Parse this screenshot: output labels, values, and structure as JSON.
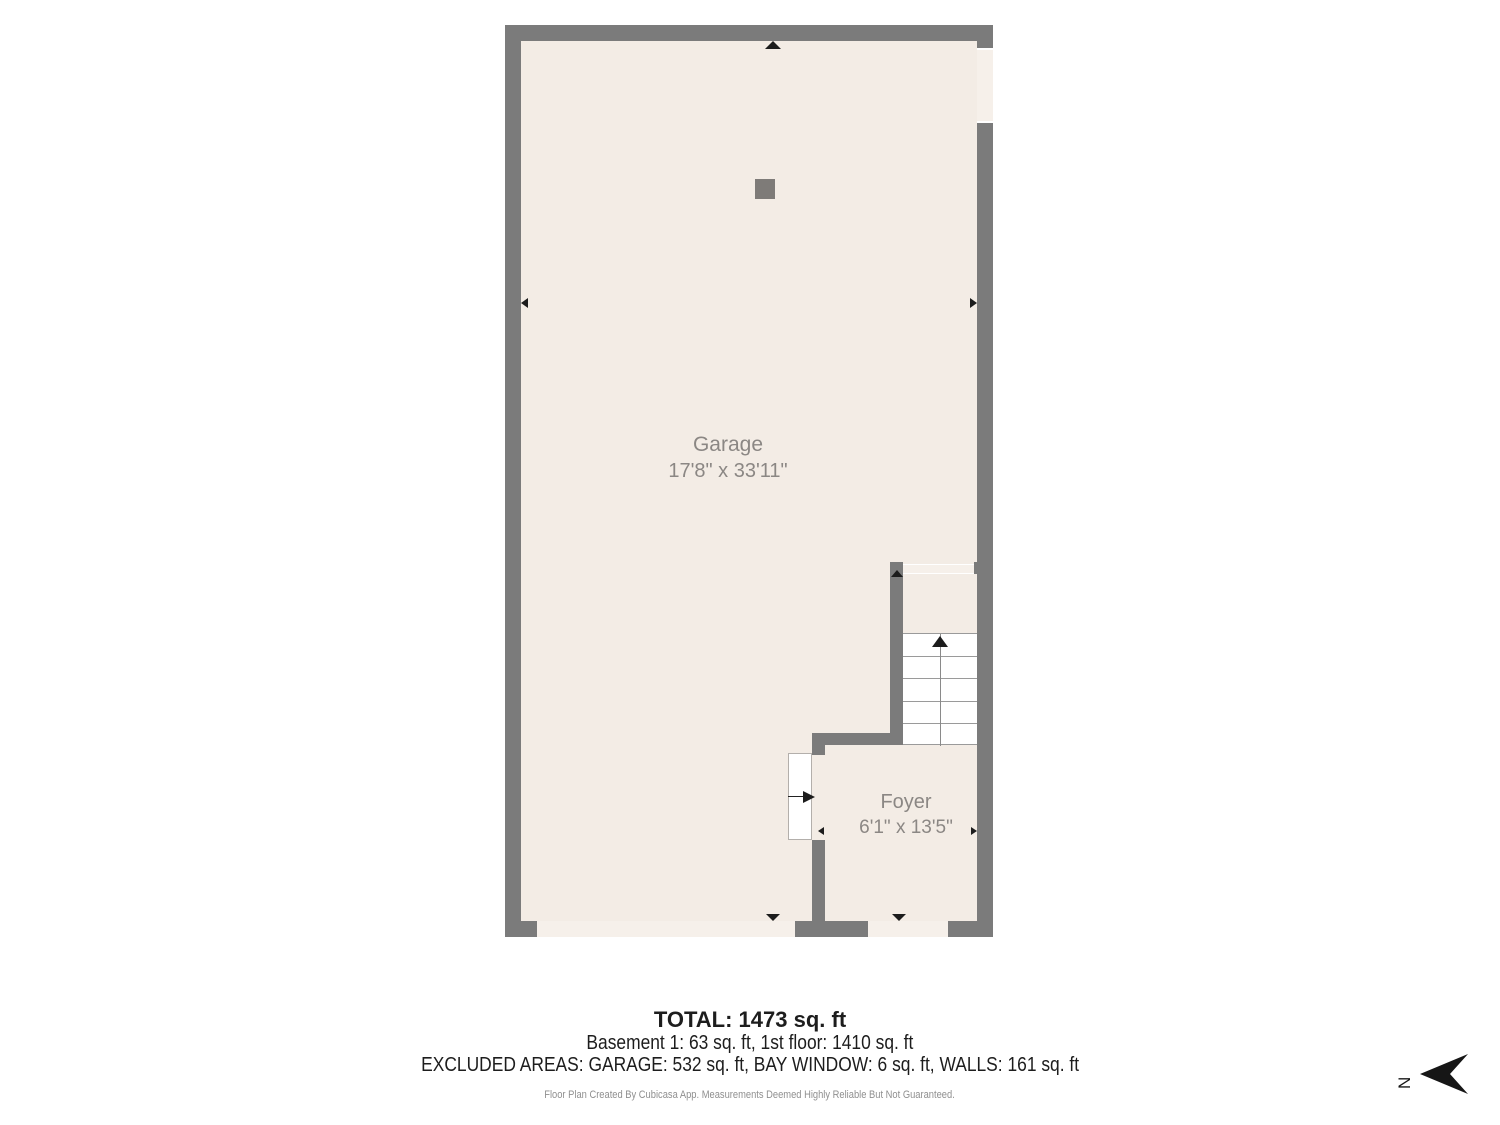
{
  "colors": {
    "wall": "#7b7b7b",
    "floor": "#f3ece5",
    "floorLight": "#f6f0ea",
    "stairLine": "#9a9a9a",
    "marker": "#1c1c1c",
    "labelText": "#8b8784",
    "footerText": "#1d1d1d",
    "mutedText": "#8f8f8f",
    "post": "#7e7b78"
  },
  "rooms": {
    "garage": {
      "name": "Garage",
      "dims": "17'8\" x 33'11\""
    },
    "foyer": {
      "name": "Foyer",
      "dims": "6'1\" x 13'5\""
    }
  },
  "footer": {
    "total": "TOTAL: 1473 sq. ft",
    "floors": "Basement 1: 63 sq. ft, 1st floor: 1410 sq. ft",
    "excluded": "EXCLUDED AREAS: GARAGE: 532 sq. ft, BAY WINDOW: 6 sq. ft, WALLS: 161 sq. ft",
    "disclaimer": "Floor Plan Created By Cubicasa App. Measurements Deemed Highly Reliable But Not Guaranteed."
  },
  "compass": {
    "label": "N"
  }
}
